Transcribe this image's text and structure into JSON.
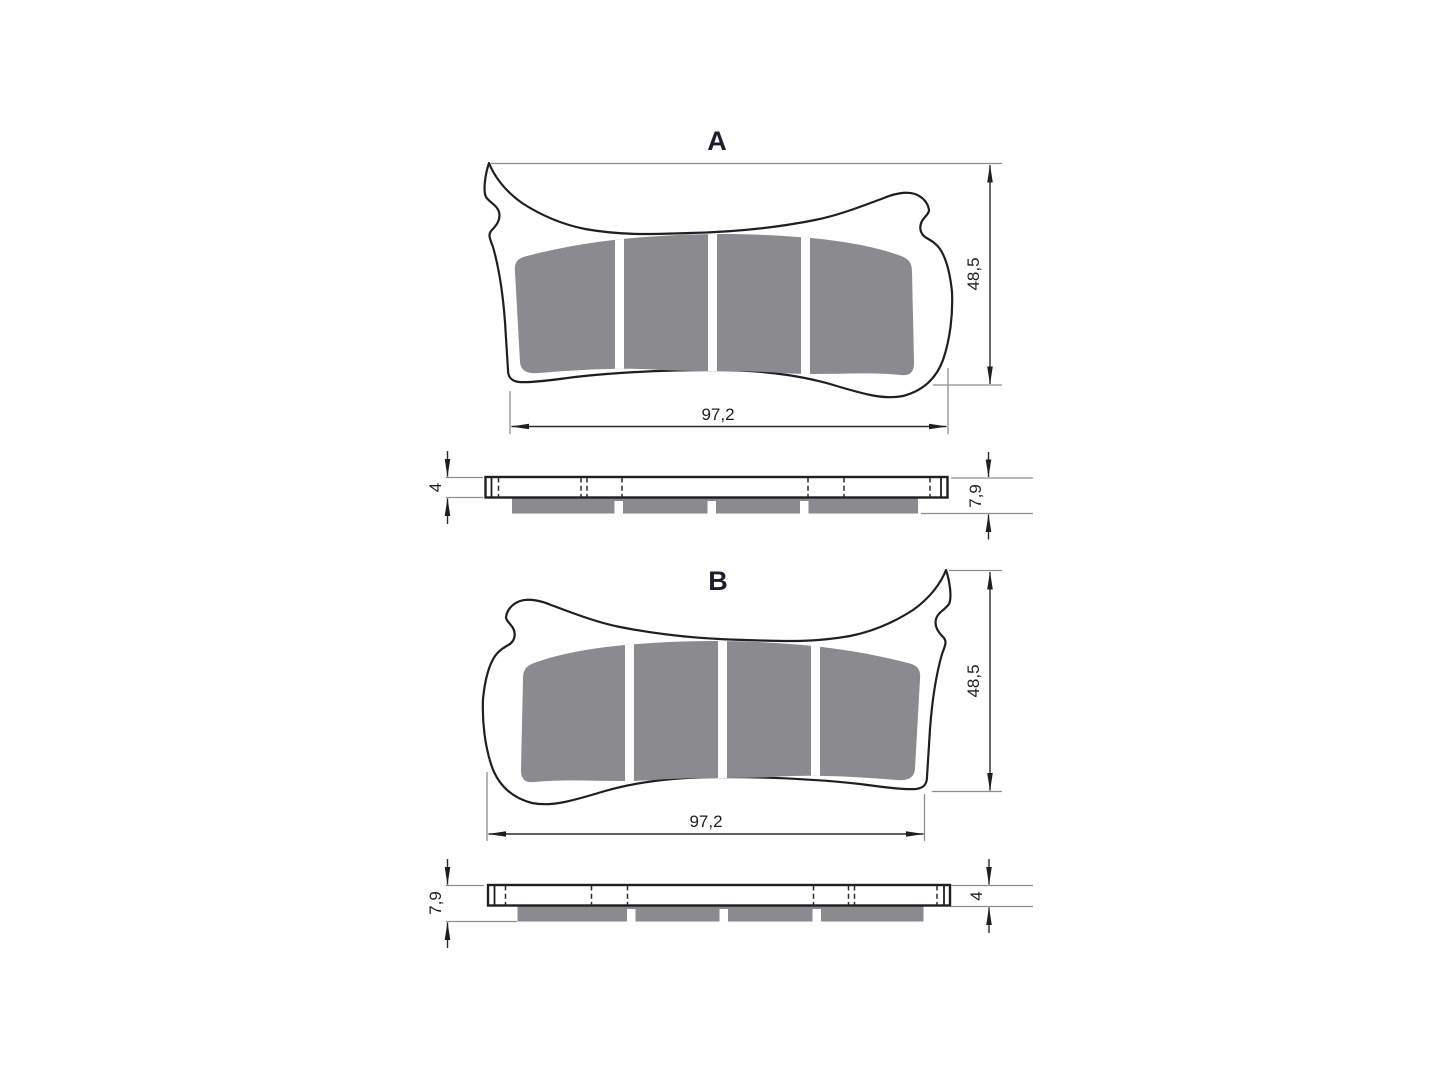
{
  "drawing_type": "brake-pad-technical-drawing",
  "views": {
    "a": {
      "label": "A",
      "front": {
        "width": "97,2",
        "height": "48,5"
      },
      "side": {
        "plate_thickness": "4",
        "total_thickness": "7,9"
      }
    },
    "b": {
      "label": "B",
      "front": {
        "width": "97,2",
        "height": "48,5"
      },
      "side": {
        "plate_thickness": "4",
        "total_thickness": "7,9"
      }
    }
  },
  "colors": {
    "background": "#ffffff",
    "outline": "#1f1f1f",
    "friction_material": "#8a8a8f",
    "extension_line": "#8d8d8d",
    "dimension_line": "#2b2b2b",
    "text": "#1e1e1e"
  }
}
